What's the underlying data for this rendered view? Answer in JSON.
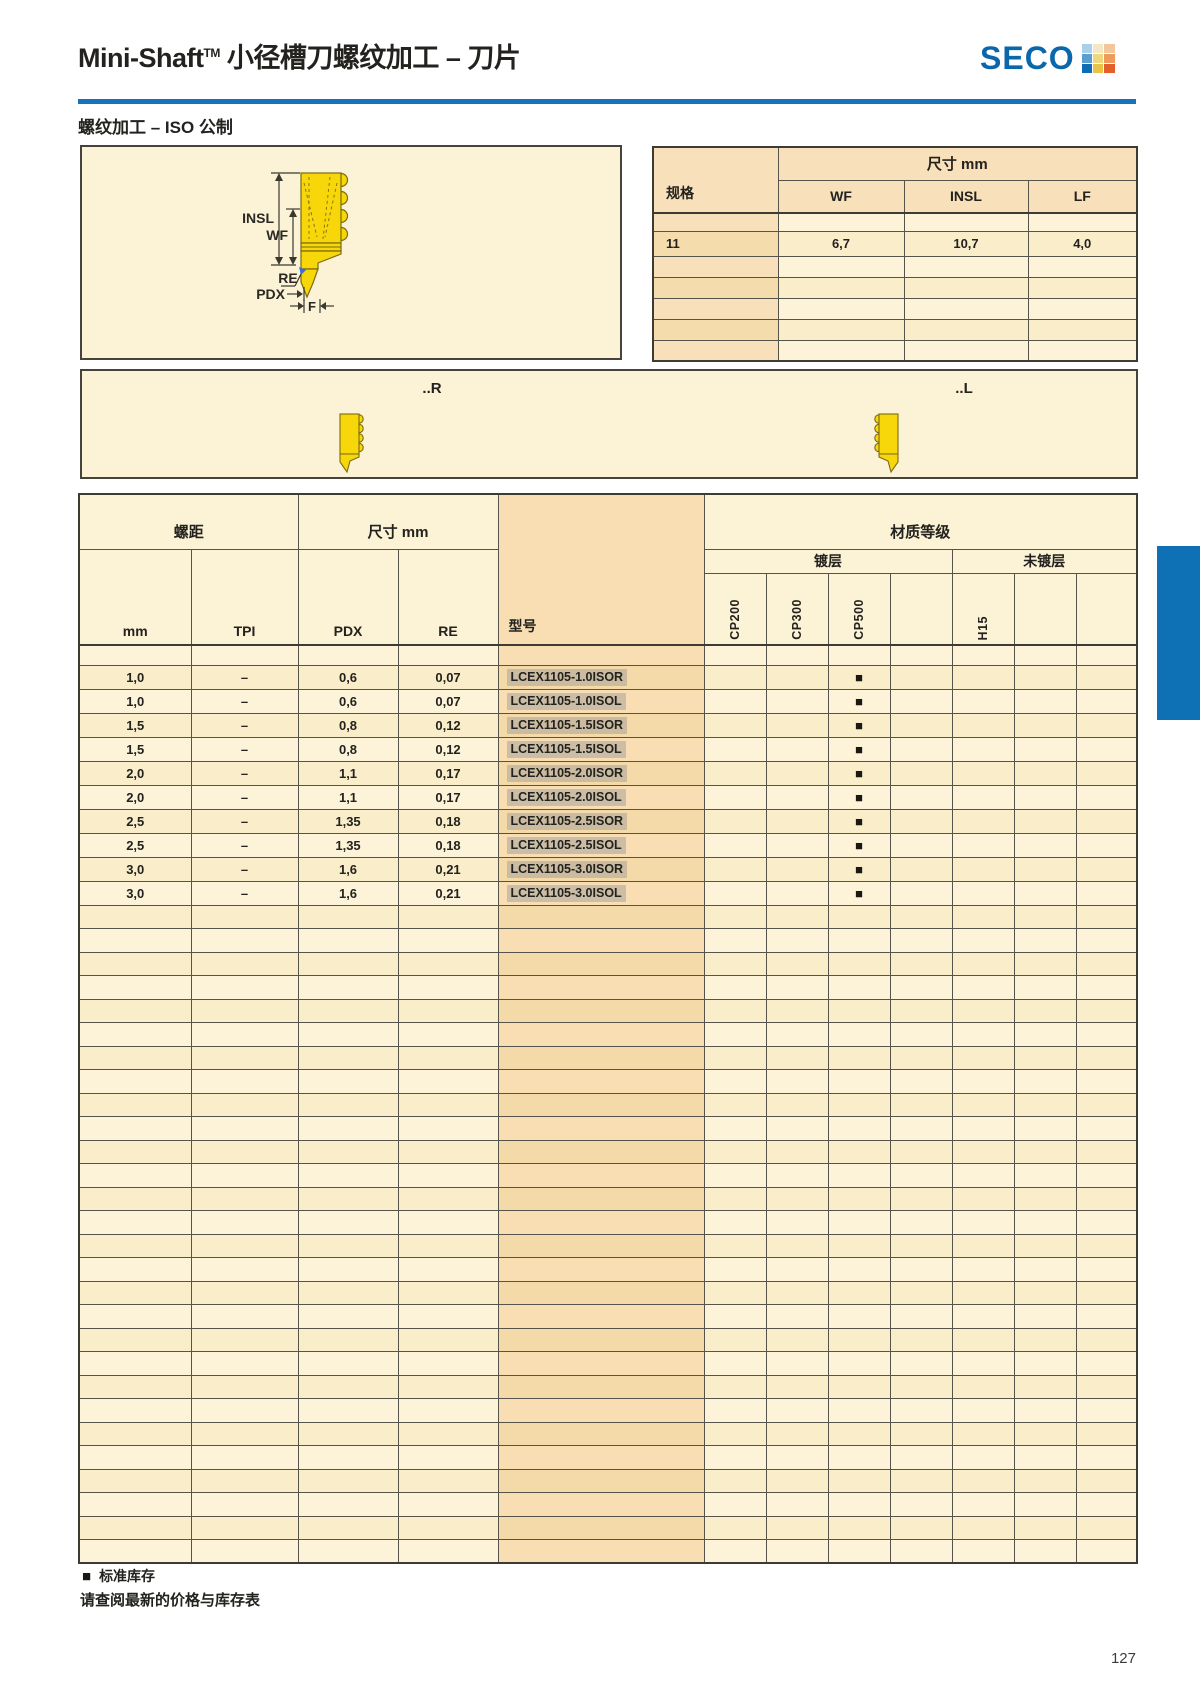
{
  "header": {
    "title_main": "Mini-Shaft",
    "title_tm": "TM",
    "title_suffix": " 小径槽刀螺纹加工 – 刀片",
    "brand": "SECO",
    "subtitle": "螺纹加工 – ISO 公制"
  },
  "colors": {
    "accent_blue": "#1374ba",
    "tab_blue": "#0e70b5",
    "panel_cream": "#fcf2d6",
    "panel_peach": "#f8deb2",
    "insert_yellow": "#f7d70a",
    "model_highlight_gray": "#d2d2d2",
    "stock_black": "#191813"
  },
  "diagram": {
    "labels": {
      "insl": "INSL",
      "wf": "WF",
      "re": "RE",
      "pdx": "PDX",
      "f": "F"
    }
  },
  "orientation_band": {
    "right": "..R",
    "left": "..L"
  },
  "spec_table": {
    "corner_label": "规格",
    "group_label": "尺寸 mm",
    "columns": [
      "WF",
      "INSL",
      "LF"
    ],
    "rows": [
      {
        "spec": "",
        "values": [
          "",
          "",
          ""
        ]
      },
      {
        "spec": "11",
        "values": [
          "6,7",
          "10,7",
          "4,0"
        ]
      },
      {
        "spec": "",
        "values": [
          "",
          "",
          ""
        ]
      },
      {
        "spec": "",
        "values": [
          "",
          "",
          ""
        ]
      },
      {
        "spec": "",
        "values": [
          "",
          "",
          ""
        ]
      },
      {
        "spec": "",
        "values": [
          "",
          "",
          ""
        ]
      },
      {
        "spec": "",
        "values": [
          "",
          "",
          ""
        ]
      }
    ]
  },
  "main_table": {
    "pitch_group": "螺距",
    "dim_group": "尺寸 mm",
    "grade_group": "材质等级",
    "coated_group": "镀层",
    "uncoated_group": "未镀层",
    "columns": {
      "mm": "mm",
      "tpi": "TPI",
      "pdx": "PDX",
      "re": "RE",
      "model": "型号"
    },
    "grade_columns": [
      "CP200",
      "CP300",
      "CP500",
      "",
      "H15",
      "",
      ""
    ],
    "stock_symbol": "■",
    "rows": [
      {
        "mm": "1,0",
        "tpi": "–",
        "pdx": "0,6",
        "re": "0,07",
        "model": "LCEX1105-1.0ISOR",
        "stock_cols": [
          2
        ]
      },
      {
        "mm": "1,0",
        "tpi": "–",
        "pdx": "0,6",
        "re": "0,07",
        "model": "LCEX1105-1.0ISOL",
        "stock_cols": [
          2
        ]
      },
      {
        "mm": "1,5",
        "tpi": "–",
        "pdx": "0,8",
        "re": "0,12",
        "model": "LCEX1105-1.5ISOR",
        "stock_cols": [
          2
        ]
      },
      {
        "mm": "1,5",
        "tpi": "–",
        "pdx": "0,8",
        "re": "0,12",
        "model": "LCEX1105-1.5ISOL",
        "stock_cols": [
          2
        ]
      },
      {
        "mm": "2,0",
        "tpi": "–",
        "pdx": "1,1",
        "re": "0,17",
        "model": "LCEX1105-2.0ISOR",
        "stock_cols": [
          2
        ]
      },
      {
        "mm": "2,0",
        "tpi": "–",
        "pdx": "1,1",
        "re": "0,17",
        "model": "LCEX1105-2.0ISOL",
        "stock_cols": [
          2
        ]
      },
      {
        "mm": "2,5",
        "tpi": "–",
        "pdx": "1,35",
        "re": "0,18",
        "model": "LCEX1105-2.5ISOR",
        "stock_cols": [
          2
        ]
      },
      {
        "mm": "2,5",
        "tpi": "–",
        "pdx": "1,35",
        "re": "0,18",
        "model": "LCEX1105-2.5ISOL",
        "stock_cols": [
          2
        ]
      },
      {
        "mm": "3,0",
        "tpi": "–",
        "pdx": "1,6",
        "re": "0,21",
        "model": "LCEX1105-3.0ISOR",
        "stock_cols": [
          2
        ]
      },
      {
        "mm": "3,0",
        "tpi": "–",
        "pdx": "1,6",
        "re": "0,21",
        "model": "LCEX1105-3.0ISOL",
        "stock_cols": [
          2
        ]
      }
    ],
    "empty_rows": 28
  },
  "footer": {
    "legend_symbol": "■",
    "legend": "标准库存",
    "note": "请查阅最新的价格与库存表",
    "page_number": "127"
  }
}
